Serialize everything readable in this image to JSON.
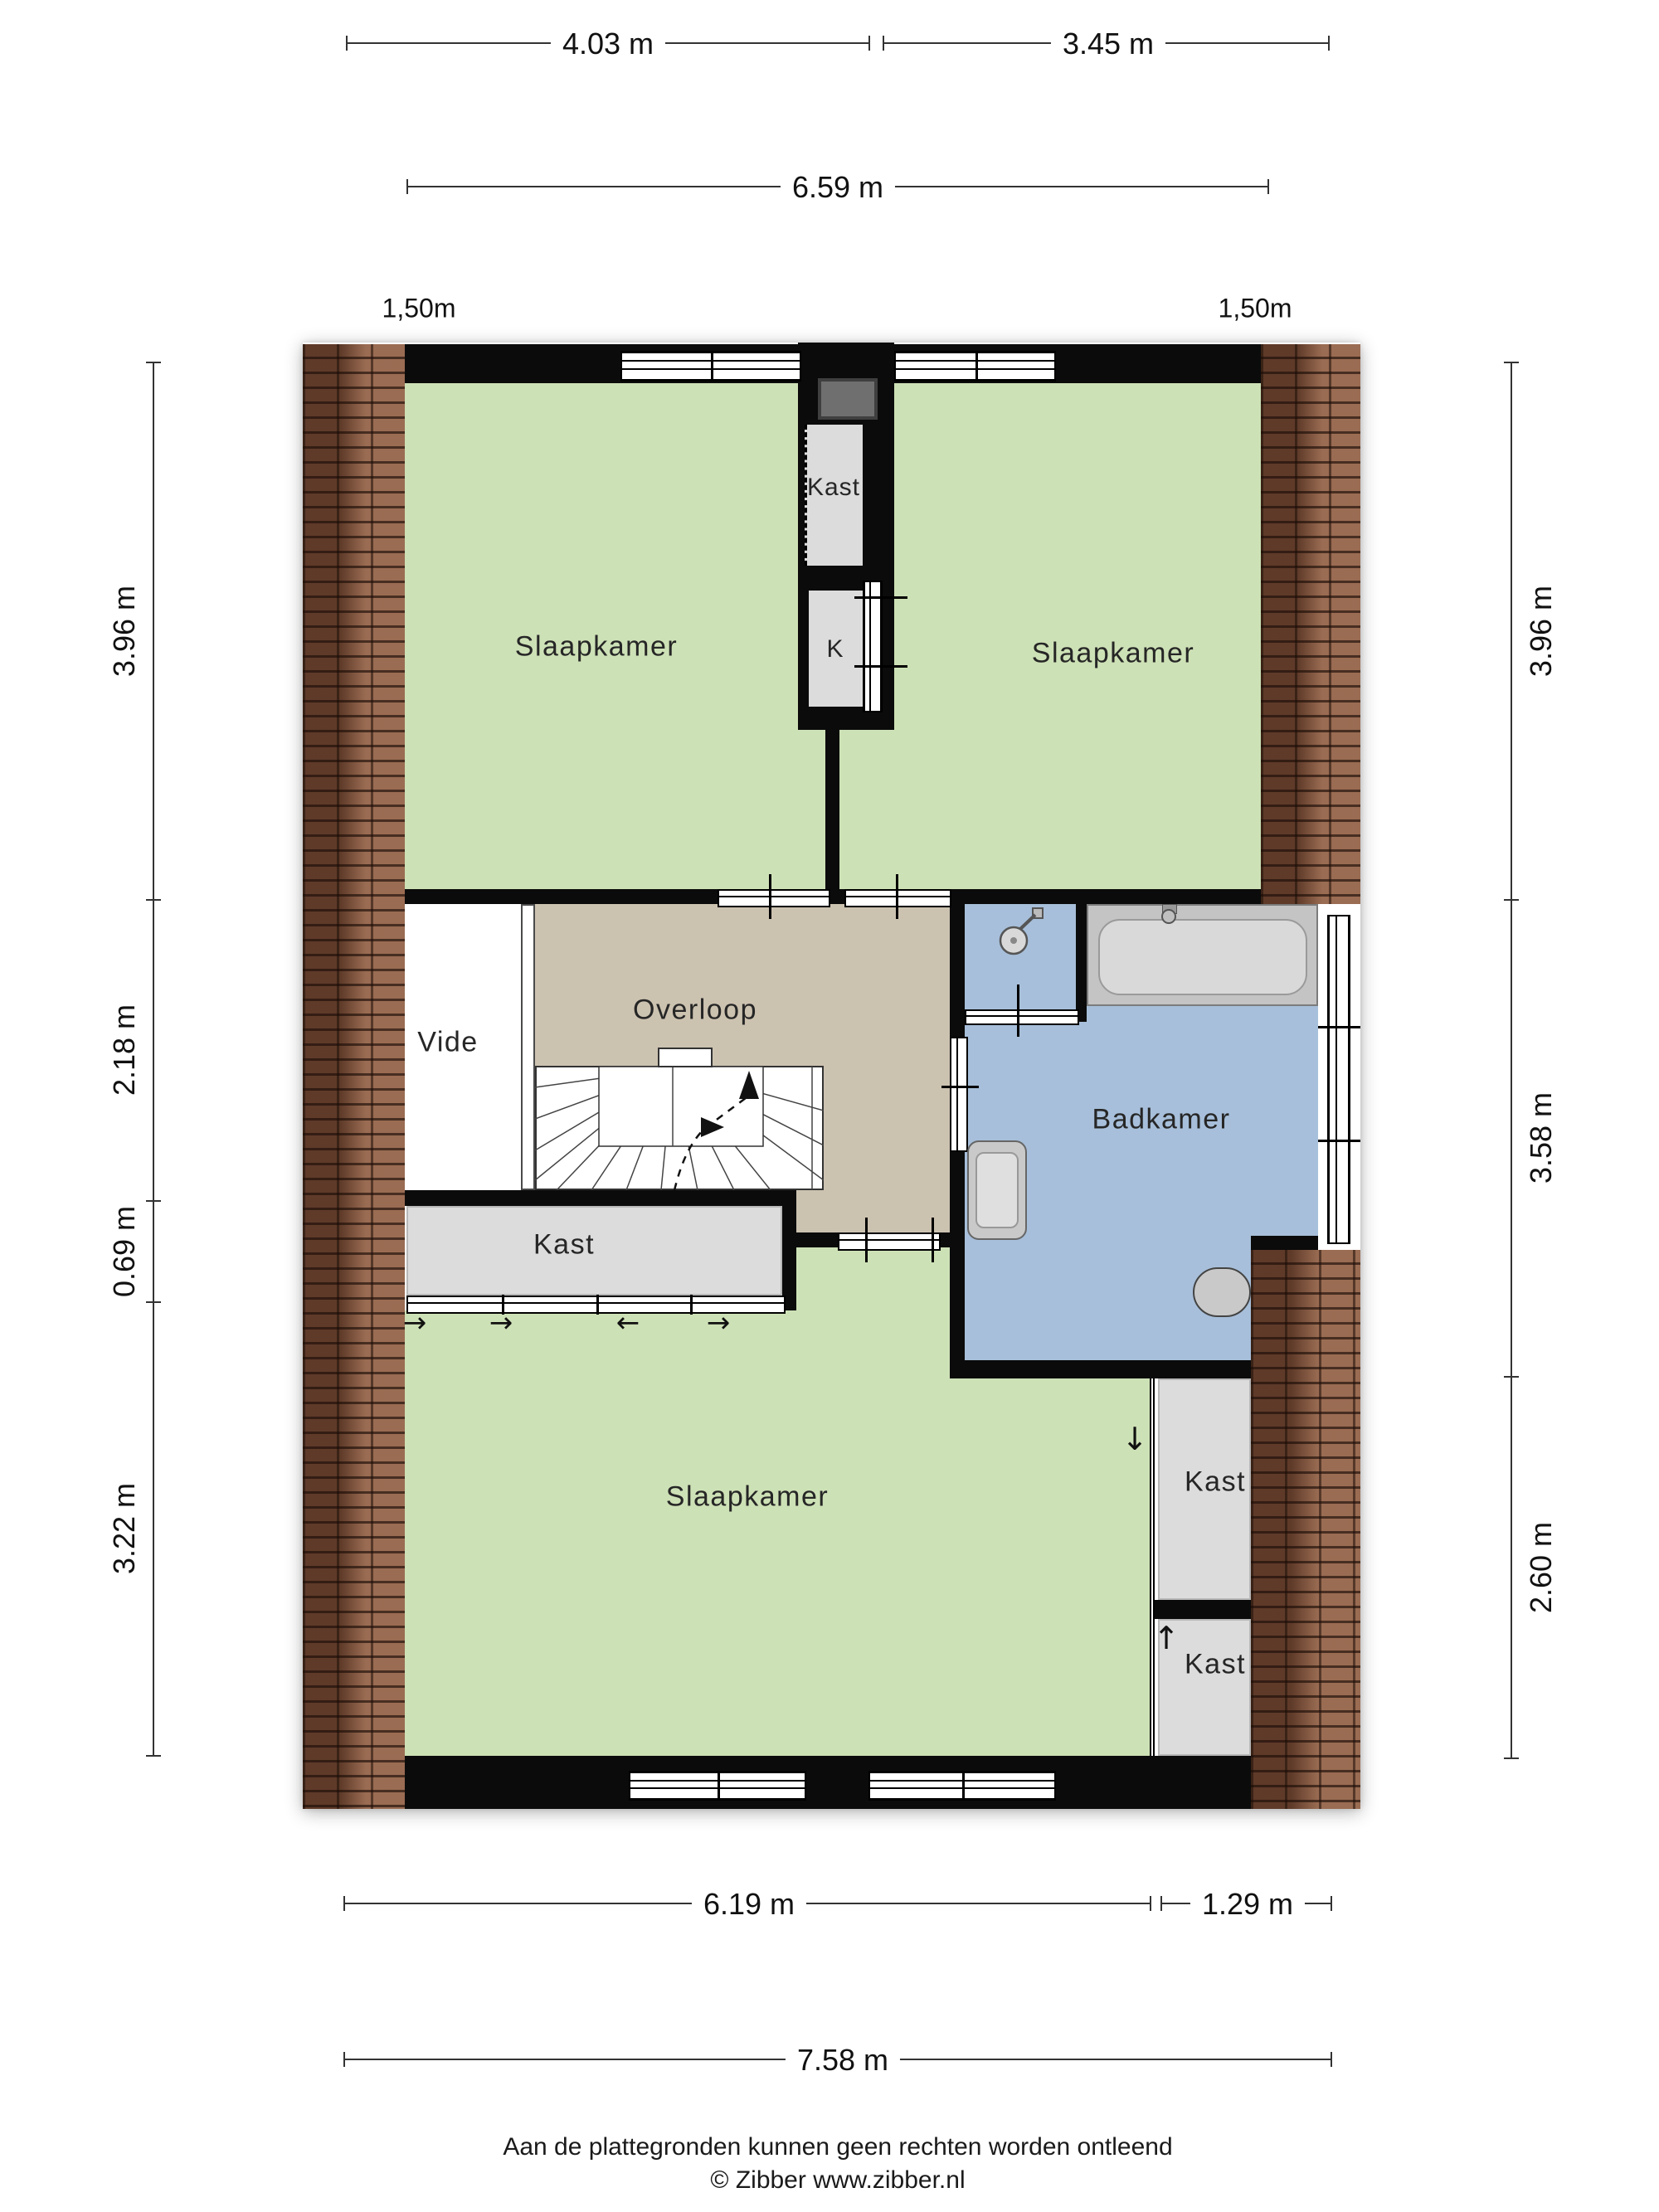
{
  "dimensions": {
    "top": [
      "4.03 m",
      "3.45 m",
      "6.59 m"
    ],
    "bottom": [
      "6.19 m",
      "1.29 m",
      "7.58 m"
    ],
    "left": [
      "3.96 m",
      "2.18 m",
      "0.69 m",
      "3.22 m"
    ],
    "right": [
      "3.96 m",
      "3.58 m",
      "2.60 m"
    ],
    "knee_left": "1,50m",
    "knee_right": "1,50m"
  },
  "rooms": {
    "slaapkamer_tl": "Slaapkamer",
    "slaapkamer_tr": "Slaapkamer",
    "slaapkamer_bottom": "Slaapkamer",
    "kast_shaft": "Kast",
    "k_closet": "K",
    "vide": "Vide",
    "overloop": "Overloop",
    "badkamer": "Badkamer",
    "kast_left": "Kast",
    "kast_right_top": "Kast",
    "kast_right_bottom": "Kast"
  },
  "arrows": {
    "slide": [
      "→",
      "→",
      "←",
      "→"
    ],
    "kast_down": "↓",
    "kast_up": "↑"
  },
  "footer": {
    "disclaimer": "Aan de plattegronden kunnen geen rechten worden ontleend",
    "copyright": "© Zibber www.zibber.nl"
  },
  "colors": {
    "room_green": "#cde1b6",
    "hall_tan": "#ccc2b0",
    "bath_blue": "#a7bfda",
    "closet_gray": "#dcdcdc",
    "wall_black": "#0b0b0b",
    "shaft_gray": "#6f6f6f",
    "fixture_gray": "#c9c9c9",
    "brick_roof": "#8a5a41"
  }
}
